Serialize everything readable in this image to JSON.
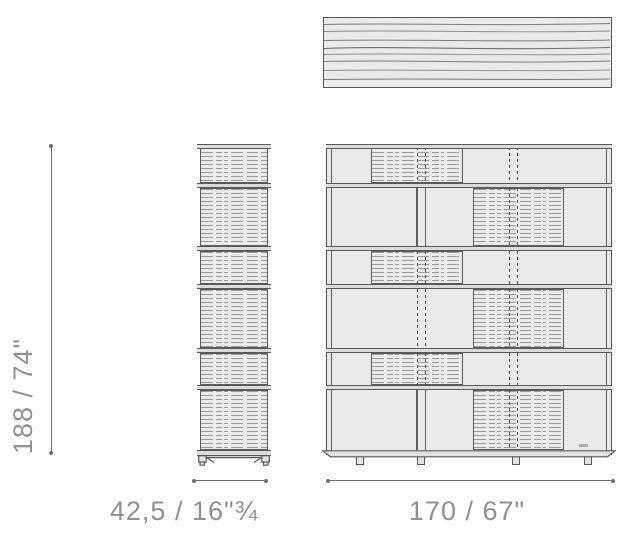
{
  "dimensions": {
    "height_label": "188 / 74\"",
    "depth_label": "42,5 / 16\"¾",
    "width_label": "170 / 67\""
  },
  "views": {
    "top_panel": "top-view-of-shelf-panel-with-wood-grain",
    "side_view": "side-view-six-stacked-compartments-on-casters",
    "front_view": "front-view-six-rows-with-sliding-doors-on-feet"
  },
  "colors": {
    "background": "#ffffff",
    "line": "#58595b",
    "panel_fill": "#eaeaea",
    "band_fill": "#dcdcdc",
    "texture_line": "#9b9b9b",
    "dimension_line": "#6d6e71",
    "label_text": "#909090"
  }
}
